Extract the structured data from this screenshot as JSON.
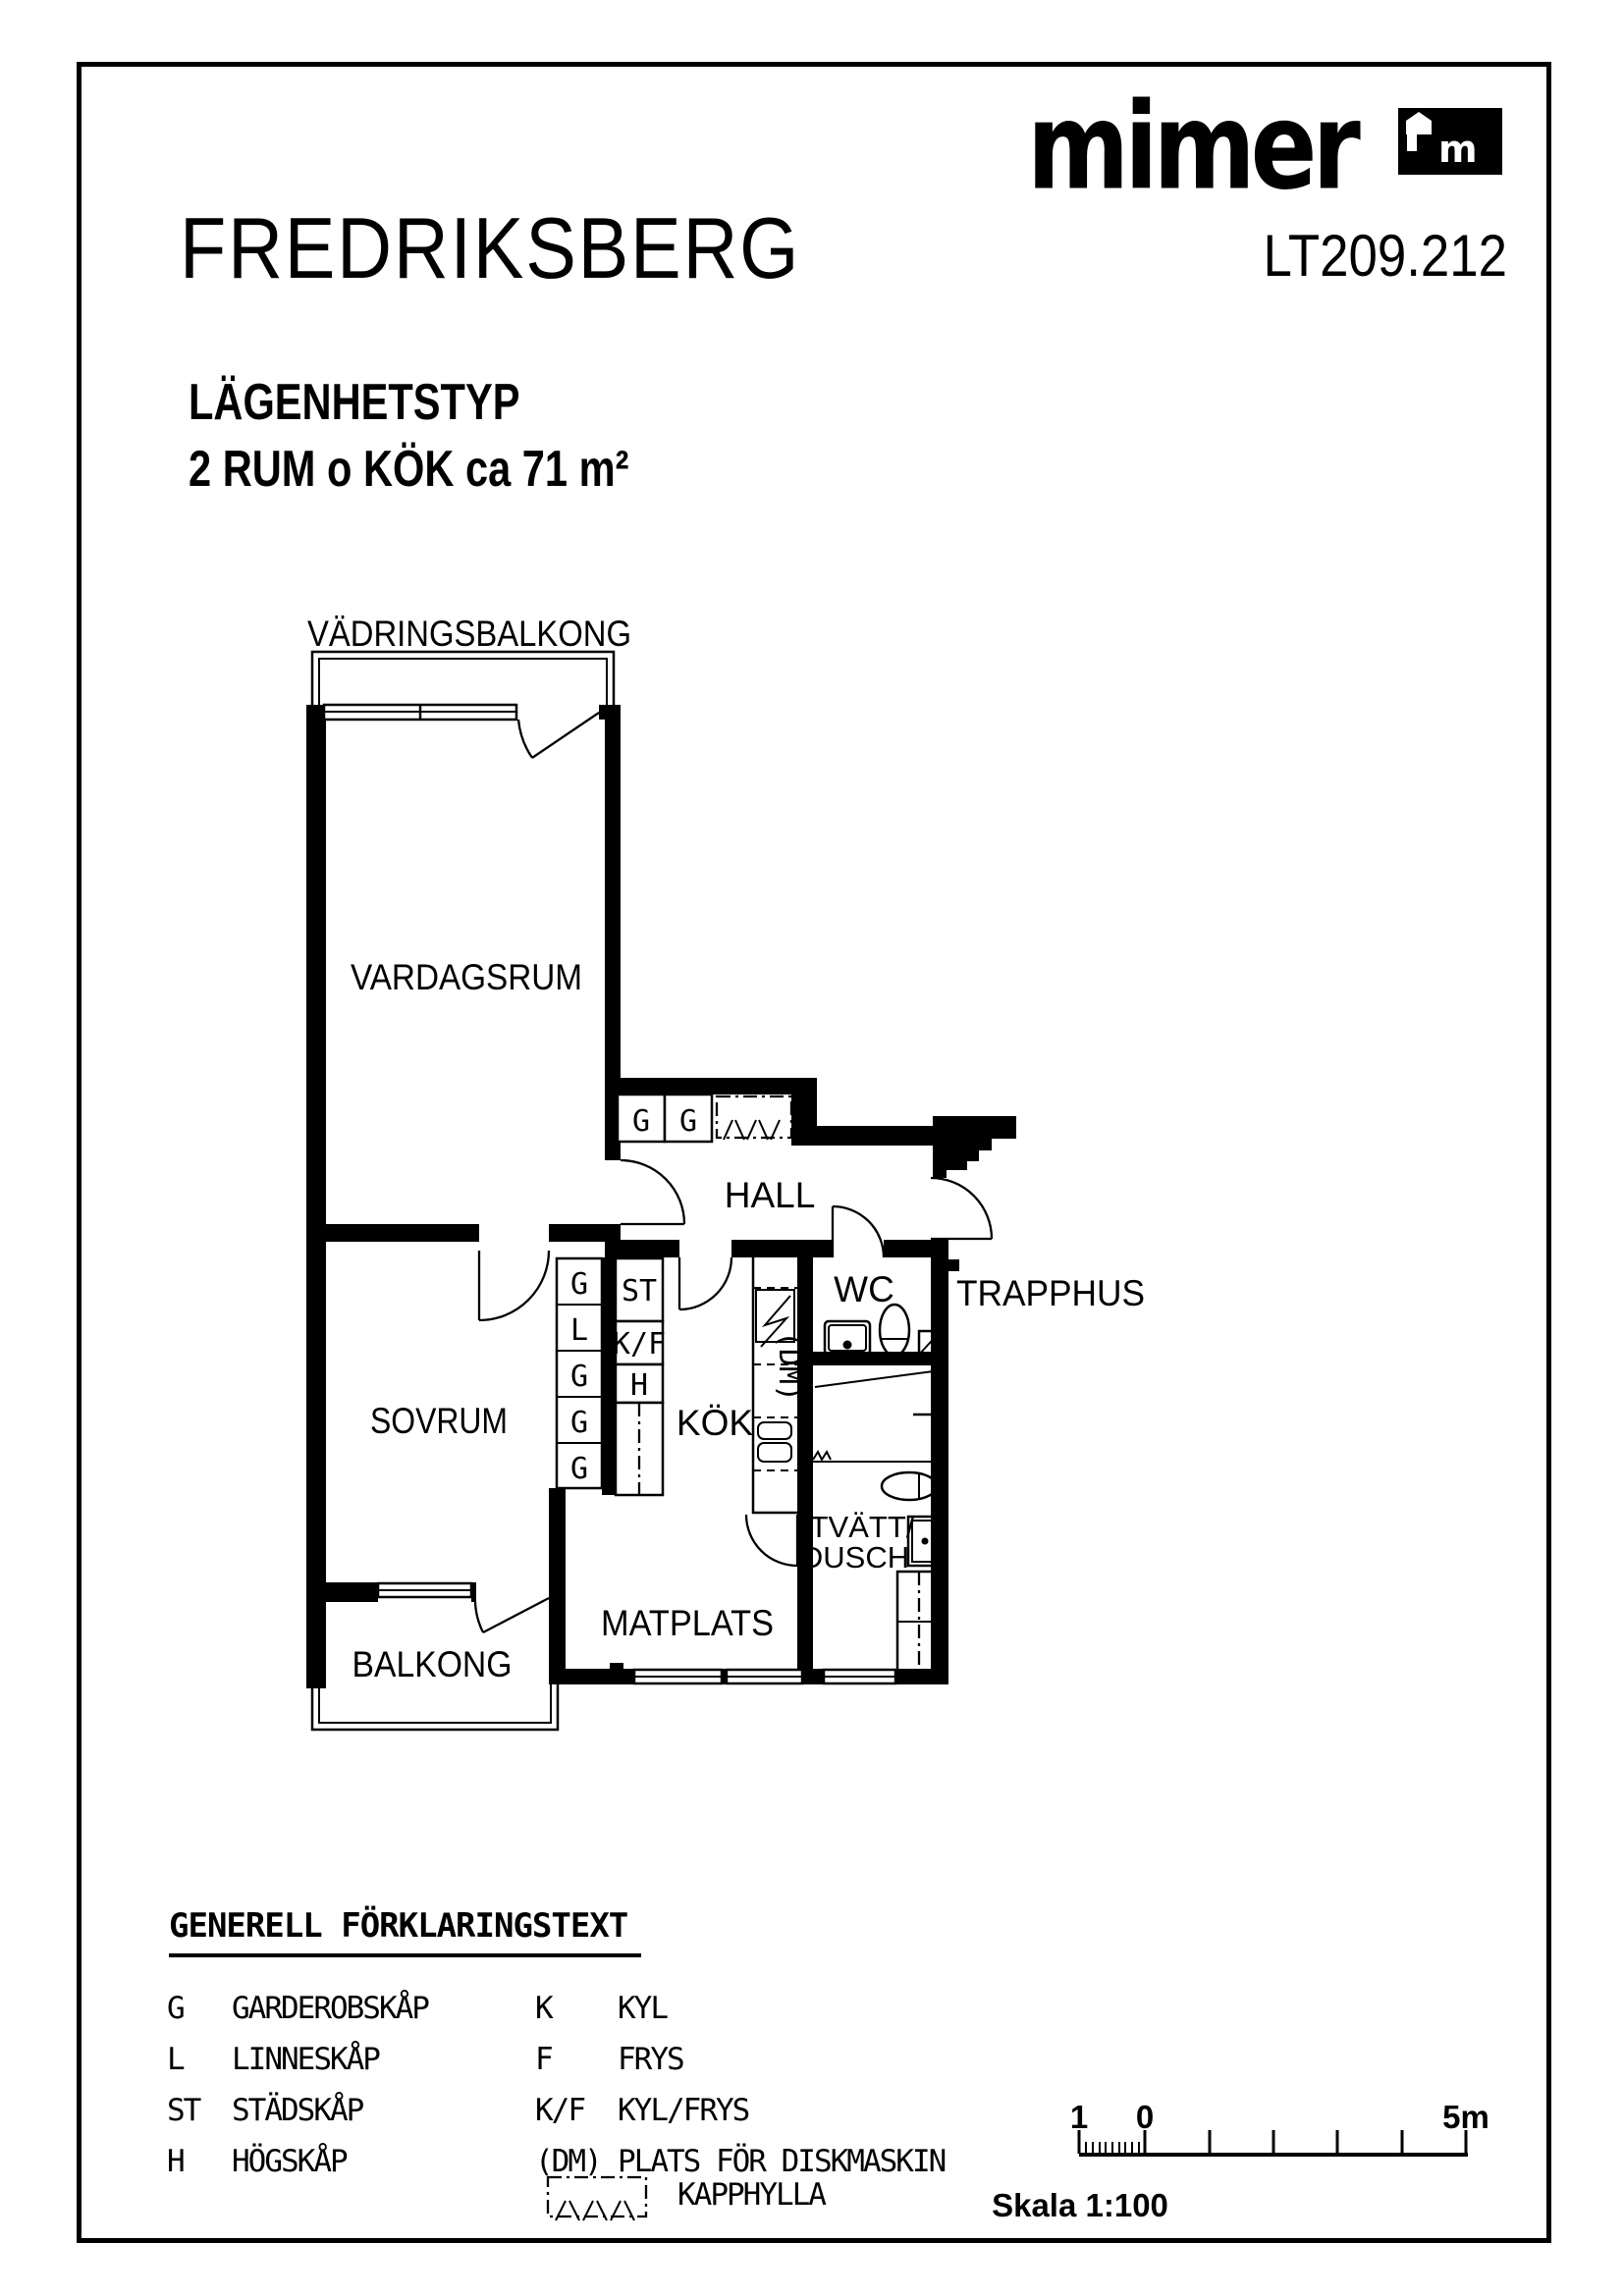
{
  "header": {
    "project_title": "FREDRIKSBERG",
    "drawing_code": "LT209.212",
    "type_heading": "LÄGENHETSTYP",
    "type_spec": "2 RUM o KÖK ca 71 m²",
    "logo_text": "mimer",
    "logo_icon_letter": "m"
  },
  "plan": {
    "rooms": {
      "vadringsbalkong": "VÄDRINGSBALKONG",
      "vardagsrum": "VARDAGSRUM",
      "hall": "HALL",
      "wc": "WC",
      "trapphus": "TRAPPHUS",
      "sovrum": "SOVRUM",
      "kok": "KÖK",
      "matplats": "MATPLATS",
      "balkong": "BALKONG",
      "tvatt_line1": "TVÄTT/",
      "tvatt_line2": "DUSCH"
    },
    "cabinets": {
      "hall": [
        "G",
        "G"
      ],
      "sovrum_wall": [
        "G",
        "L",
        "G",
        "G",
        "G"
      ],
      "kok_wall": [
        "ST",
        "K/F",
        "H"
      ],
      "dm_marker": "(DM)"
    }
  },
  "legend": {
    "heading": "GENERELL FÖRKLARINGSTEXT",
    "left": [
      {
        "key": "G",
        "label": "GARDEROBSKÅP"
      },
      {
        "key": "L",
        "label": "LINNESKÅP"
      },
      {
        "key": "ST",
        "label": "STÄDSKÅP"
      },
      {
        "key": "H",
        "label": "HÖGSKÅP"
      }
    ],
    "right": [
      {
        "key": "K",
        "label": "KYL"
      },
      {
        "key": "F",
        "label": "FRYS"
      },
      {
        "key": "K/F",
        "label": "KYL/FRYS"
      },
      {
        "key": "(DM)",
        "label": "PLATS FÖR DISKMASKIN"
      }
    ],
    "kapphylla": "KAPPHYLLA"
  },
  "scalebar": {
    "label_1": "1",
    "label_0": "0",
    "label_5m": "5m",
    "caption": "Skala 1:100"
  },
  "colors": {
    "ink": "#000000",
    "paper": "#ffffff"
  }
}
